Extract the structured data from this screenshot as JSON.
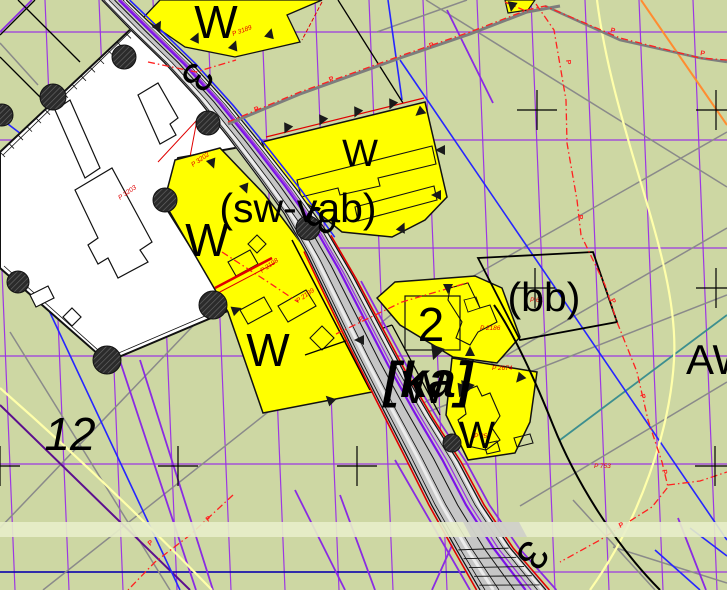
{
  "map": {
    "background_color": "#cdd7a3",
    "parcel_fill_color": "#ffff00",
    "grid_color": "#9a2fe6",
    "road_fill_color": "#c6c6c6",
    "boundary_dash_color": "#ff2020",
    "zone_labels": [
      {
        "id": "w-top",
        "text": "W"
      },
      {
        "id": "w-mid-right",
        "text": "W"
      },
      {
        "id": "w-mid-left",
        "text": "W"
      },
      {
        "id": "w-lower-left",
        "text": "W"
      },
      {
        "id": "w-on-road",
        "text": "W"
      },
      {
        "id": "w-bottom-right",
        "text": "W"
      }
    ],
    "planning_labels": {
      "sw_vab": "(sw-vab)",
      "bb": "(bb)",
      "ka": "[ka]",
      "aw": "AW"
    },
    "parcel_numbers": {
      "block": "2",
      "flur": "12"
    },
    "road_station_markers": [
      "3",
      "3",
      "3"
    ],
    "survey_point_labels": [
      "P 3203",
      "P 3202",
      "P 2199",
      "P 2198",
      "P 2186",
      "P 2674",
      "P 753",
      "P 3189",
      "P 359",
      "P 61"
    ],
    "boundary_marker_letter": "P"
  }
}
